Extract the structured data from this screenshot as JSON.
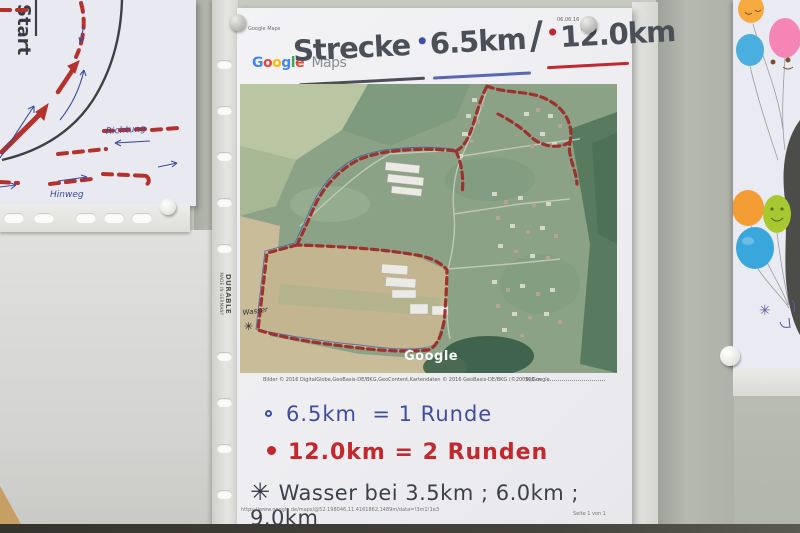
{
  "left_sheet": {
    "start": "Start",
    "richtung": "Richtung",
    "hinweg": "Hinweg"
  },
  "sleeve": {
    "brand": "DURABLE",
    "made_in": "MADE IN GERMANY"
  },
  "sheet": {
    "header_app": "Google Maps",
    "header_date": "06.06.16",
    "logo_google_letters": [
      "G",
      "o",
      "o",
      "g",
      "l",
      "e"
    ],
    "logo_maps": "Maps",
    "title": {
      "word": "Strecke",
      "bullet1": "•",
      "dist1": "6.5km",
      "slash": "/",
      "bullet2": "•",
      "dist2": "12.0km"
    },
    "map": {
      "watermark": "Google",
      "wasser_label": "Wasser",
      "wasser_star": "✳",
      "credit": "Bilder © 2016 DigitalGlobe,GeoBasis-DE/BKG,GeoContent,Kartendaten © 2016 GeoBasis-DE/BKG (©2009),Google",
      "scale_label": "100 m"
    },
    "legend": {
      "line1_dist": "6.5km",
      "line1_eq": "= 1 Runde",
      "line2_dist": "12.0km",
      "line2_eq": "= 2 Runden",
      "line3_star": "✳",
      "line3_text": "Wasser bei 3.5km ; 6.0km ; 9.0km"
    },
    "footer": {
      "url": "https://www.google.de/maps/@52.198046,11.4161862,1489m/data=!3m1!1e3",
      "page": "Seite 1 von 1"
    }
  },
  "right_sheet": {
    "star": "✳"
  },
  "colors": {
    "route_red": "#9e2b27",
    "ink_blue": "#3e4da0",
    "marker_red": "#c2282c",
    "marker_dark": "#4b4f58"
  }
}
